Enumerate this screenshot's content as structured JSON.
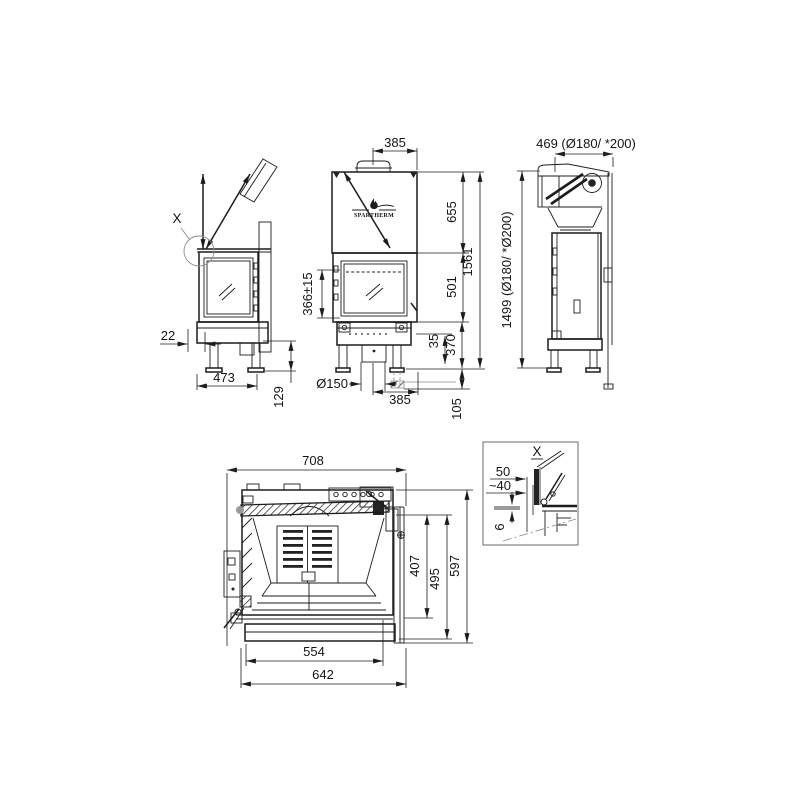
{
  "drawing": {
    "brand": "SPARTHERM",
    "side_view": {
      "detail_label": "X",
      "dims": {
        "inset": "22",
        "depth": "473",
        "leg": "129"
      }
    },
    "front_view": {
      "dims": {
        "flue_top": "385",
        "hood": "655",
        "total": "1561",
        "firebox": "501",
        "glass": "366±15",
        "lip": "35",
        "base": "370",
        "flue": "Ø150",
        "flue_bottom": "385",
        "below": "105"
      }
    },
    "rear_view": {
      "dims": {
        "width": "469 (Ø180/ *200)",
        "height": "1499 (Ø180/ *Ø200)"
      }
    },
    "plan_view": {
      "dims": {
        "width": "708",
        "depth_a": "407",
        "depth_b": "495",
        "depth_c": "597",
        "front_a": "554",
        "front_b": "642"
      }
    },
    "detail_view": {
      "label": "X",
      "dims": {
        "a": "50",
        "b": "~40",
        "c": "6"
      }
    }
  }
}
